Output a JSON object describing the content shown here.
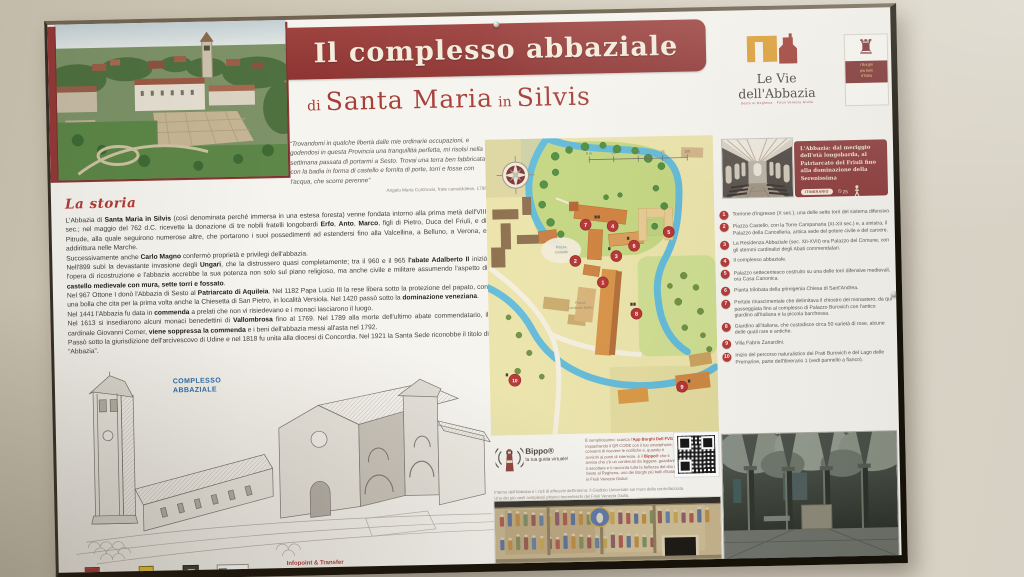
{
  "banner": {
    "title": "Il complesso abbaziale"
  },
  "subtitle": {
    "di": "di",
    "main": "Santa Maria",
    "in": "in",
    "end": "Silvis"
  },
  "quote": {
    "text": "“Trovandomi in qualche libertà dalle mie ordinarie occupazioni, e godendosi in questa Provincia una tranquillità perfetta, mi risolsi nella settimana passata di portarmi a Sesto. Trovai una terra ben fabbricata con la badia in forma di castello e fornita di porte, torri e fosse con l'acqua, che scorre perenne”",
    "attribution": "Angelo Maria Cortinovis, frate camaldolese, 1798"
  },
  "story": {
    "heading": "La storia",
    "paragraphs": [
      "L'Abbazia di **Santa Maria in Silvis** (così denominata perché immersa in una estesa foresta) venne fondata intorno alla prima metà dell'VIII sec.; nel maggio del 762 d.C. ricevette la donazione di tre nobili fratelli longobardi **Erfo**, **Anto**, **Marco**, figli di Pietro, Duca del Friuli, e di Pitrude, alla quale seguirono numerose altre, che portarono i suoi possedimenti ad estendersi fino alla Valcellina, a Belluno, a Verona, e addirittura nelle Marche.",
      "Successivamente anche **Carlo Magno** confermò proprietà e privilegi dell'abbazia.",
      "Nell'899 subì la devastante invasione degli **Ungari**, che la distrussero quasi completamente; tra il 960 e il 965 **l'abate Adalberto II** iniziò l'opera di ricostruzione e l'abbazia accrebbe la sua potenza non solo sul piano religioso, ma anche civile e militare assumendo l'aspetto di **castello medievale con mura, sette torri e fossato**.",
      "Nel 967 Ottone I donò l'Abbazia di Sesto al **Patriarcato di Aquileia**. Nel 1182 Papa Lucio III la rese libera sotto la protezione del papato, con una bolla che cita per la prima volta anche la Chiesetta di San Pietro, in località Versiola. Nel 1420 passò sotto la **dominazione veneziana**.",
      "Nel 1441 l'Abbazia fu data in **commenda** a prelati che non vi risiedevano e i monaci lasciarono il luogo.",
      "Nel 1613 si insediarono alcuni monaci benedettini di **Vallombrosa** fino al 1769. Nel 1789 alla morte dell'ultimo abate commendatario, il cardinale Giovanni Corner, **viene soppressa la commenda** e i beni dell'abbazia messi all'asta nel 1792.",
      "Passò sotto la giurisdizione dell'arcivescovo di Udine e nel 1818 fu unita alla diocesi di Concordia. Nel 1921 la Santa Sede riconobbe il titolo di “Abbazia”."
    ]
  },
  "illustration": {
    "label": "COMPLESSO ABBAZIALE"
  },
  "footer": {
    "infopoint_title": "Infopoint & Transfer",
    "address": "Piazza Castello 5 - Sesto al Reghena - Pordenone - I - Tel. 0434 699701",
    "web": "www.abbaziasesto.it - infopoint.sesto@gmail.com - www.borghitalia.it"
  },
  "map": {
    "scale": [
      "0 m",
      "25",
      "50",
      "75",
      "100"
    ],
    "labels": {
      "piazza_castello": [
        "Piazza",
        "Castello"
      ],
      "piazza_barbo": [
        "Piazza",
        "Cardinale Barbo"
      ]
    },
    "markers": [
      "1",
      "2",
      "3",
      "4",
      "5",
      "6",
      "7",
      "8",
      "9",
      "10"
    ]
  },
  "bippo": {
    "name": "Bippo®",
    "tagline": "la tua guida virtuale!",
    "text": "È semplicissimo: scarica l'**App Borghi Dell FVG** inquadrando il QR CODE con il tuo smartphone; consenti di ricevere le notifiche e, quando ti avvicini ai punti di interesse, è il **Bippo®** che ti avvisa che c'è un contenuto da leggere, guardare o ascoltare e ti racconta tutta la bellezza del sito di Sesto al Reghena, uno dei Borghi più belli d'Italia in Friuli Venezia Giulia!"
  },
  "fresco": {
    "caption_line1": "Interno dell'Abbazia e i cicli di affreschi dell'interno: il Giudizio Universale sul muro della controfacciata.",
    "caption_line2": "Uno dei più vasti complessi pittorici trecenteschi del Friuli Venezia Giulia."
  },
  "right": {
    "logo_vie": {
      "title": "Le Vie dell'Abbazia",
      "tagline": "Sesto al Reghena · Friuli Venezia Giulia"
    },
    "logo_borghi": {
      "line1": "I Borghi",
      "line2": "più belli",
      "line3": "d'Italia"
    },
    "itinerary_box": {
      "text": "L'Abbazia: dal meriggio dell'età longobarda, al Patriarcato del Friuli fino alla dominazione della Serenissima",
      "badge": "ITINERARIO",
      "duration": "25"
    },
    "itinerary": [
      {
        "num": "1",
        "text": "Torrione d'ingresso (X sec.), una delle sette torri del sistema difensivo."
      },
      {
        "num": "2",
        "text": "Piazza Castello, con la Torre Campanaria (XI-XII sec.) e, a sinistra, il Palazzo della Cancelleria, antica sede del potere civile e del carcere."
      },
      {
        "num": "3",
        "text": "La Residenza Abbaziale (sec. XII-XVII) ora Palazzo del Comune, con gli stemmi cardinalizi degli Abati commendatari."
      },
      {
        "num": "4",
        "text": "Il complesso abbaziale."
      },
      {
        "num": "5",
        "text": "Palazzo settecentesco costruito su una delle torri difensive medievali, ora Casa Canonica."
      },
      {
        "num": "6",
        "text": "Pianta trilobata della primigenia Chiesa di Sant'Andrea."
      },
      {
        "num": "7",
        "text": "Portale rinascimentale che delimitava il chiostro del monastero; da qui passeggiata fino al complesso di Palazzo Burovich con l'antico giardino all'italiana e la piccola barchessa."
      },
      {
        "num": "8",
        "text": "Giardino all'italiana, che custodisce circa 50 varietà di rose, alcune delle quali rare e antiche."
      },
      {
        "num": "9",
        "text": "Villa Fabris Zanardini."
      },
      {
        "num": "10",
        "text": "Inizio del percorso naturalistico dei Prati Burovich e del Lago delle Premarine, parte dell'itinerario 1 (vedi pannello a fianco)."
      }
    ]
  },
  "colors": {
    "banner_red": "#953a38",
    "accent_red": "#b23734",
    "label_blue": "#2a6cab",
    "box_red": "#8c3b3a"
  }
}
